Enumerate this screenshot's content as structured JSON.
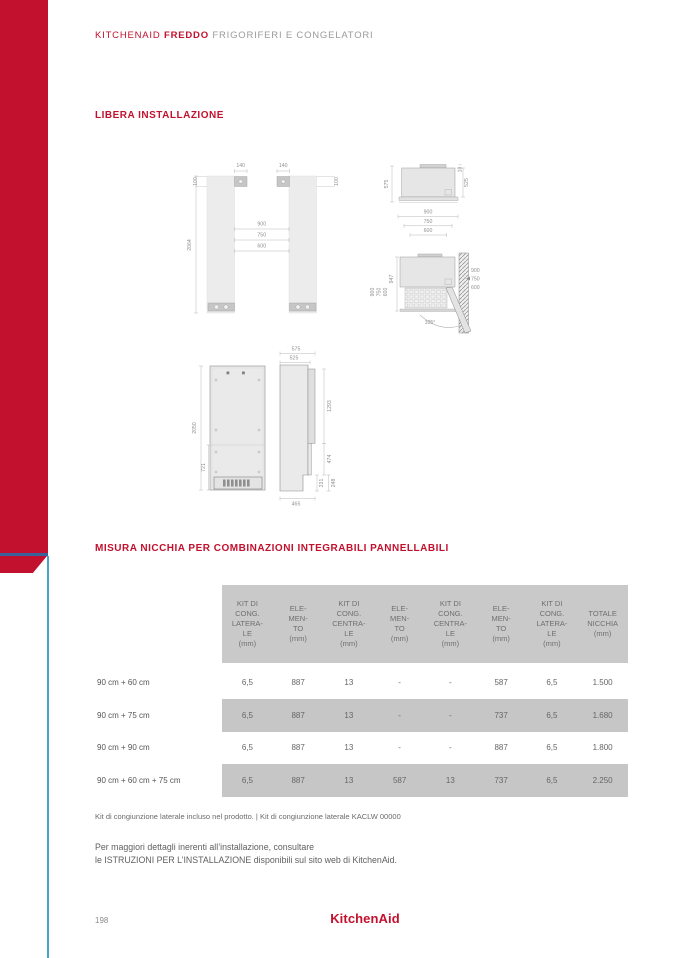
{
  "header": {
    "brand": "KITCHENAID",
    "product": "FREDDO",
    "subtitle": "FRIGORIFERI E CONGELATORI"
  },
  "sections": {
    "free_installation": "LIBERA INSTALLAZIONE",
    "niche_title": "MISURA NICCHIA PER COMBINAZIONI INTEGRABILI PANNELLABILI"
  },
  "diagrams": {
    "front_view": {
      "plate_w_left": "140",
      "plate_w_right": "140",
      "plate_h_left": "100",
      "plate_h_right": "100",
      "total_height": "2064",
      "widths": [
        "900",
        "750",
        "600"
      ]
    },
    "top_view": {
      "depth_total": "575",
      "door_offset": "10",
      "depth_body": "525",
      "widths": [
        "900",
        "750",
        "600"
      ]
    },
    "open_door_view": {
      "depth": "947",
      "widths_left": [
        "900",
        "750",
        "600"
      ],
      "widths_right": [
        "900",
        "750",
        "600"
      ],
      "angle": "105°"
    },
    "rear_view": {
      "total_height": "2050",
      "lower_height": "721"
    },
    "side_view": {
      "depth_total": "575",
      "depth_body": "525",
      "door_height": "1293",
      "mid_height": "474",
      "plinth_inner": "231",
      "plinth_outer": "248",
      "base_depth": "465"
    }
  },
  "table": {
    "columns": [
      "KIT DI\nCONG.\nLATERA-\nLE\n(mm)",
      "ELE-\nMEN-\nTO\n(mm)",
      "KIT DI\nCONG.\nCENTRA-\nLE\n(mm)",
      "ELE-\nMEN-\nTO\n(mm)",
      "KIT DI\nCONG.\nCENTRA-\nLE\n(mm)",
      "ELE-\nMEN-\nTO\n(mm)",
      "KIT DI\nCONG.\nLATERA-\nLE\n(mm)",
      "TOTALE\nNICCHIA\n(mm)"
    ],
    "rows": [
      {
        "label": "90 cm + 60 cm",
        "values": [
          "6,5",
          "887",
          "13",
          "-",
          "-",
          "587",
          "6,5",
          "1.500"
        ]
      },
      {
        "label": "90 cm + 75 cm",
        "values": [
          "6,5",
          "887",
          "13",
          "-",
          "-",
          "737",
          "6,5",
          "1.680"
        ]
      },
      {
        "label": "90 cm + 90 cm",
        "values": [
          "6,5",
          "887",
          "13",
          "-",
          "-",
          "887",
          "6,5",
          "1.800"
        ]
      },
      {
        "label": "90 cm + 60 cm + 75 cm",
        "values": [
          "6,5",
          "887",
          "13",
          "587",
          "13",
          "737",
          "6,5",
          "2.250"
        ]
      }
    ]
  },
  "notes": {
    "kit_note": "Kit di congiunzione laterale incluso nel prodotto. | Kit di congiunzione laterale KACLW 00000",
    "install_line1": "Per maggiori dettagli inerenti all’installazione, consultare",
    "install_line2": "le ISTRUZIONI PER L’INSTALLAZIONE disponibili sul sito web di KitchenAid."
  },
  "footer": {
    "page_number": "198",
    "logo": "KitchenAid"
  },
  "colors": {
    "brand_red": "#C2112E",
    "line_blue": "#3A639B",
    "line_teal": "#45A5CB",
    "table_gray": "#C9C9C9"
  }
}
